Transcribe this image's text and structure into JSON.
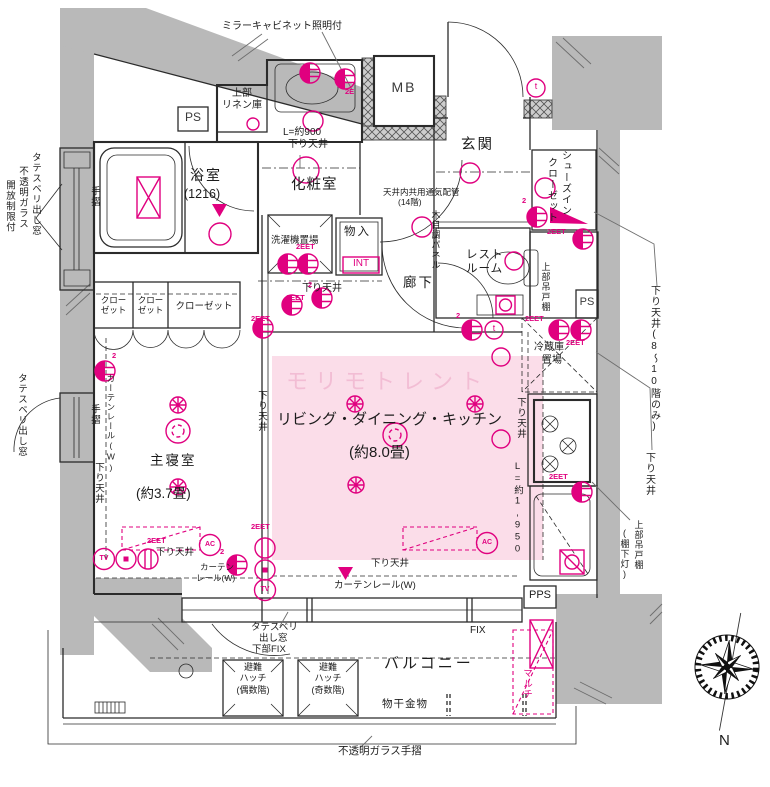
{
  "watermark": "モリモトレント",
  "rooms": {
    "bathroom": "浴室",
    "bathroom_size": "(1216)",
    "powder_room": "化粧室",
    "entrance": "玄関",
    "shoes_closet_1": "シューズイン",
    "shoes_closet_2": "クローゼット",
    "restroom_1": "レスト",
    "restroom_2": "ルーム",
    "corridor": "廊下",
    "storage": "物入",
    "storage_tag": "INT",
    "laundry": "洗濯機置場",
    "closet_a1": "クロー",
    "closet_a2": "ゼット",
    "closet_wide": "クローゼット",
    "bedroom": "主寝室",
    "bedroom_size": "(約3.7畳)",
    "ldk": "リビング・ダイニング・キッチン",
    "ldk_size": "(約8.0畳)",
    "fridge_1": "冷蔵庫",
    "fridge_2": "置場",
    "balcony": "バルコニー",
    "linen_1": "上部",
    "linen_2": "リネン庫",
    "mb": "MB",
    "ps": "PS",
    "pps": "PPS"
  },
  "labels": {
    "mirror_cabinet": "ミラーキャビネット照明付",
    "l900_1": "L=約900",
    "l900_2": "下り天井",
    "vent_1": "天井内共用通気配管",
    "vent_2": "(14階)",
    "wood_panel": "木目調パネル",
    "upper_hanging": "上部吊戸棚",
    "upper_hanging_light": "(棚下灯)",
    "down_ceiling": "下り天井",
    "down_ceiling_8_10": "下り天井(8〜10階のみ)",
    "l1950": "L=約1,950",
    "curtain_rail_w": "カーテンレール(W)",
    "curtain_1": "カーテン",
    "curtain_2": "レール(W)",
    "tate_mado": "タテスベリ出し窓",
    "opaque_glass": "不透明ガラス",
    "open_limit": "開放制限付",
    "handrail": "手摺",
    "tate_1": "タテスベリ",
    "tate_2": "出し窓",
    "tate_3": "下部FIX",
    "fix": "FIX",
    "hatch_1": "避難",
    "hatch_2": "ハッチ",
    "hatch_even": "(偶数階)",
    "hatch_odd": "(奇数階)",
    "drying": "物干金物",
    "opaque_rail": "不透明ガラス手摺",
    "multi": "マルチ",
    "north": "N"
  },
  "symbols": {
    "eet": "2EET",
    "e2": "2E",
    "two": "2",
    "tv": "TV",
    "ac": "AC",
    "t": "t"
  },
  "colors": {
    "accent": "#e0007f",
    "ldk_fill": "#fbdde9",
    "watermark": "#f2bad2",
    "wall_gray": "#b9b9b9",
    "line": "#2b2b2b"
  }
}
